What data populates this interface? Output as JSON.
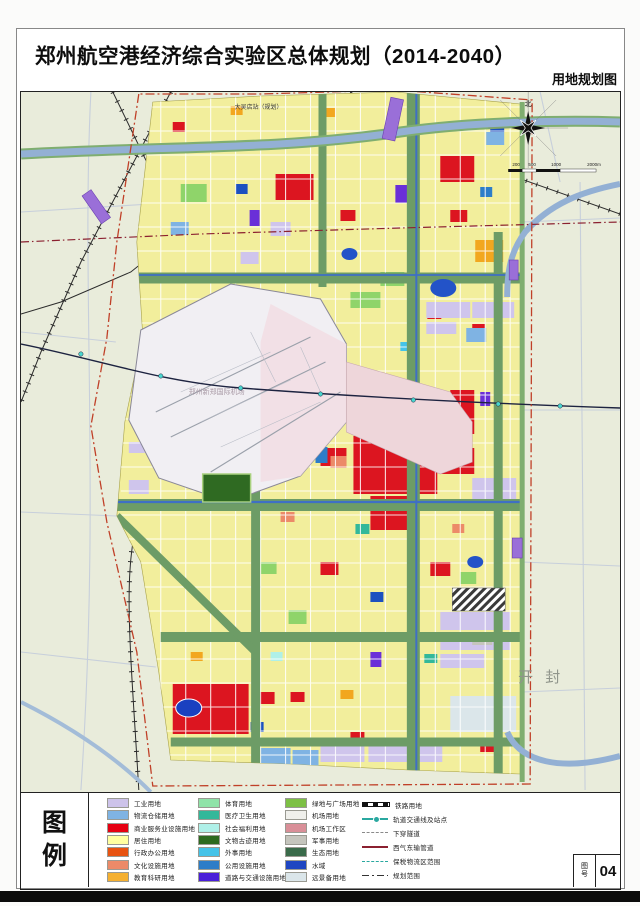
{
  "header": {
    "title": "郑州航空港经济综合实验区总体规划（2014-2040）",
    "subtitle": "用地规划图"
  },
  "map": {
    "labels": {
      "station_north": "大吴店站（规划）",
      "airport": "郑州新郑国际机场",
      "kaifeng": "开 封"
    },
    "compass_label": "北",
    "scale_ticks": [
      "200",
      "500",
      "1000",
      "2000m"
    ],
    "boundary_color": "#c04028",
    "planning_area_color": "#f2ee9c",
    "green_corridor_color": "#6d9c66",
    "river_color": "#93b0d4"
  },
  "legend": {
    "title_chars": [
      "图",
      "例"
    ],
    "columns": [
      {
        "items": [
          {
            "label": "工业用地",
            "color": "#cdc3ea"
          },
          {
            "label": "物流仓储用地",
            "color": "#7fb3e3"
          },
          {
            "label": "商业服务业设施用地",
            "color": "#e60012"
          },
          {
            "label": "居住用地",
            "color": "#ffffa0"
          },
          {
            "label": "行政办公用地",
            "color": "#e85311"
          },
          {
            "label": "文化设施用地",
            "color": "#ec8a68"
          },
          {
            "label": "教育科研用地",
            "color": "#f5b031"
          }
        ]
      },
      {
        "items": [
          {
            "label": "体育用地",
            "color": "#8fe3a8"
          },
          {
            "label": "医疗卫生用地",
            "color": "#33b89a"
          },
          {
            "label": "社会福利用地",
            "color": "#aff0e8"
          },
          {
            "label": "文物古迹用地",
            "color": "#2d6a1f"
          },
          {
            "label": "外事用地",
            "color": "#45c3e8"
          },
          {
            "label": "公用设施用地",
            "color": "#2d7dc8"
          },
          {
            "label": "道路与交通设施用地",
            "color": "#4a1fd9"
          }
        ]
      },
      {
        "items": [
          {
            "label": "绿地与广场用地",
            "color": "#7dc045"
          },
          {
            "label": "机场用地",
            "color": "#f0f0ec"
          },
          {
            "label": "机场工作区",
            "color": "#d98f98"
          },
          {
            "label": "军事用地",
            "color": "#c5c5bd"
          },
          {
            "label": "生态用地",
            "color": "#3a6b4a"
          },
          {
            "label": "水域",
            "color": "#1f46c2"
          },
          {
            "label": "远景备用地",
            "color": "#dbe6ea"
          }
        ]
      }
    ],
    "line_items": [
      {
        "label": "铁路用地",
        "style": "rail",
        "color": "#111111"
      },
      {
        "label": "轨道交通线及站点",
        "style": "metro",
        "color": "#2aa8a0"
      },
      {
        "label": "下穿隧道",
        "style": "dashed",
        "color": "#8a8a8a"
      },
      {
        "label": "西气东输管道",
        "style": "solid",
        "color": "#8b2030"
      },
      {
        "label": "保税物流区范围",
        "style": "dashed",
        "color": "#2aa8a0"
      },
      {
        "label": "规划范围",
        "style": "dashdot",
        "color": "#333333"
      }
    ]
  },
  "title_block": {
    "sheet_label_chars": [
      "图",
      "号"
    ],
    "sheet_number": "04"
  }
}
